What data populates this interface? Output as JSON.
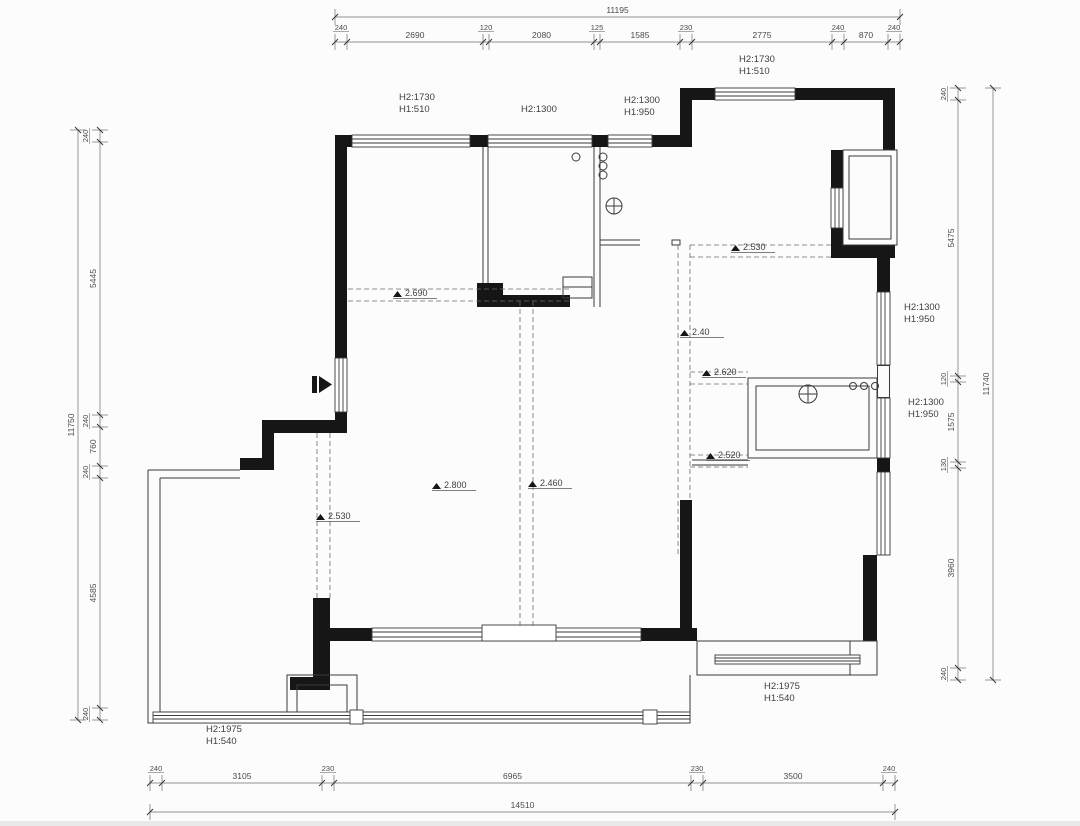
{
  "dimension_chains": {
    "top": {
      "overall": "11195",
      "segments": [
        "240",
        "2690",
        "120",
        "2080",
        "125",
        "1585",
        "230",
        "2775",
        "240",
        "870",
        "240"
      ]
    },
    "bottom": {
      "overall": "14510",
      "segments": [
        "240",
        "3105",
        "230",
        "6965",
        "230",
        "3500",
        "240"
      ]
    },
    "left": {
      "overall": "11750",
      "segments": [
        "240",
        "5445",
        "240",
        "760",
        "240",
        "4585",
        "240"
      ]
    },
    "right": {
      "overall": "11740",
      "segments": [
        "240",
        "5475",
        "120",
        "1575",
        "130",
        "3960",
        "240"
      ]
    }
  },
  "window_labels": [
    {
      "id": "top-left-window",
      "lines": [
        "H2:1730",
        "H1:510"
      ],
      "x": 399,
      "y": 100
    },
    {
      "id": "top-middle-window",
      "lines": [
        "H2:1300"
      ],
      "x": 521,
      "y": 112
    },
    {
      "id": "top-bath-window",
      "lines": [
        "H2:1300",
        "H1:950"
      ],
      "x": 624,
      "y": 103
    },
    {
      "id": "upper-right-window",
      "lines": [
        "H2:1730",
        "H1:510"
      ],
      "x": 739,
      "y": 62
    },
    {
      "id": "right-upper-window",
      "lines": [
        "H2:1300",
        "H1:950"
      ],
      "x": 904,
      "y": 310
    },
    {
      "id": "right-lower-window",
      "lines": [
        "H2:1300",
        "H1:950"
      ],
      "x": 908,
      "y": 405
    },
    {
      "id": "bottom-right-window",
      "lines": [
        "H2:1975",
        "H1:540"
      ],
      "x": 764,
      "y": 689
    },
    {
      "id": "bottom-left-window",
      "lines": [
        "H2:1975",
        "H1:540"
      ],
      "x": 206,
      "y": 732
    }
  ],
  "elevation_markers": [
    {
      "value": "2.690",
      "x": 393,
      "y": 297
    },
    {
      "value": "2.800",
      "x": 432,
      "y": 489
    },
    {
      "value": "2.460",
      "x": 528,
      "y": 487
    },
    {
      "value": "2.530",
      "x": 316,
      "y": 520
    },
    {
      "value": "2.530",
      "x": 731,
      "y": 251
    },
    {
      "value": "2.40",
      "x": 680,
      "y": 336
    },
    {
      "value": "2.620",
      "x": 702,
      "y": 376
    },
    {
      "value": "2.520",
      "x": 706,
      "y": 459
    }
  ],
  "colors": {
    "background": "#fcfcfc",
    "wall_fill": "#161616",
    "line": "#3a3a3a",
    "dashed": "#6a6a6a",
    "dimension": "#4a4a4a"
  }
}
